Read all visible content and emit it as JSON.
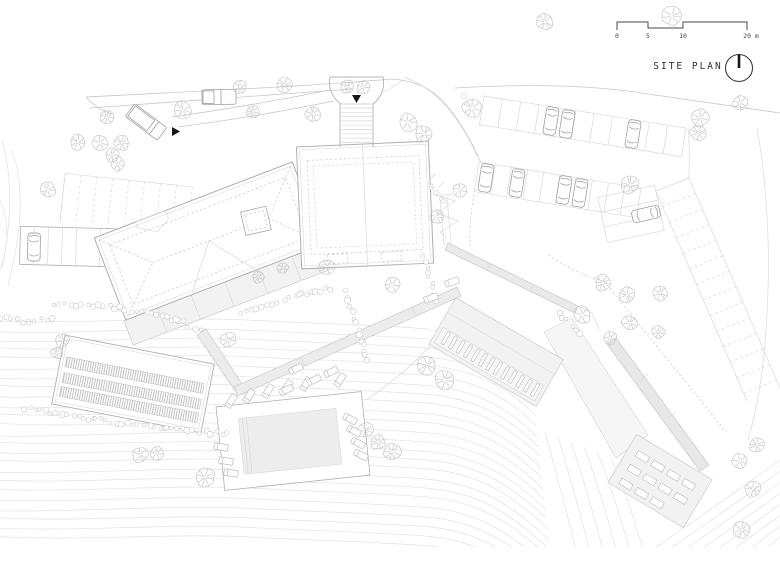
{
  "header": {
    "title": "SITE PLAN"
  },
  "scale_bar": {
    "unit_labels": [
      "0",
      "5",
      "10",
      "20 m"
    ]
  },
  "palette": {
    "paper": "#ffffff",
    "line_light": "#e2e2e2",
    "line": "#c7c7c7",
    "line_mid": "#b0b0b0",
    "accent_black": "#161616",
    "fill_soft": "#f2f2f2",
    "fill_walk": "#ececec",
    "text": "#303030"
  }
}
